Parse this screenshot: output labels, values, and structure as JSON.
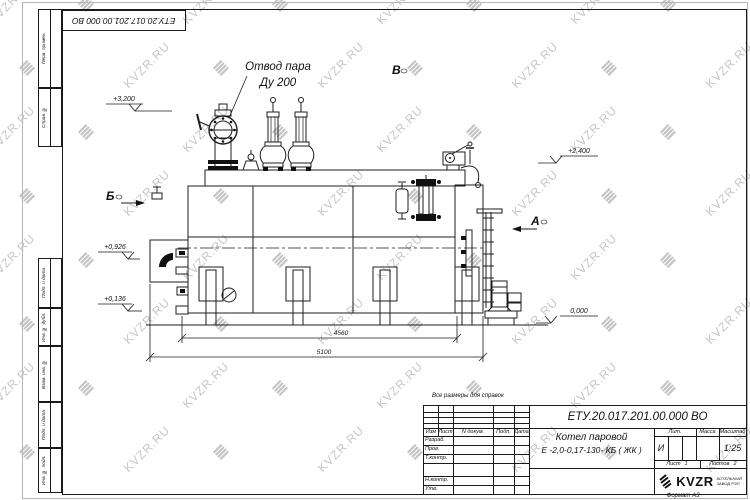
{
  "watermark": {
    "text": "KVZR.RU",
    "icon_glyph": "≣"
  },
  "stamp_top": {
    "doc_number": "ЕТУ.20.017.201.00.000  ВО"
  },
  "margin": {
    "labels": [
      "Перв. примен.",
      "Справ. №",
      "Подп. и дата",
      "Инв. № дубл.",
      "Взам. инв. №",
      "Подп. и дата",
      "Инв. № подл."
    ]
  },
  "drawing": {
    "callout": {
      "line1": "Отвод пара",
      "line2": "Ду 200"
    },
    "note": "Все размеры для справок",
    "elevations": {
      "e3200": "+3,200",
      "e2400": "+2,400",
      "e0926": "+0,926",
      "e0136": "+0,136",
      "e0000": "0,000"
    },
    "sections": {
      "b": "Б",
      "v": "В",
      "a": "А"
    },
    "dimensions": {
      "d4560": "4560",
      "d5100": "5100"
    }
  },
  "title_block": {
    "doc_number": "ЕТУ.20.017.201.00.000  ВО",
    "name_line1": "Котел паровой",
    "name_line2": "Е -2,0-0,17-130- КБ ( ЖК )",
    "cols": {
      "izm": "Изм",
      "list": "Лист",
      "doc": "N докум.",
      "podp": "Подп.",
      "data": "Дата"
    },
    "rows": {
      "r1": "Разраб.",
      "r2": "Пров.",
      "r3": "Т.контр.",
      "r4": "Н.контр.",
      "r5": "Утв."
    },
    "lit": {
      "label": "Лит.",
      "value": "И"
    },
    "mass": {
      "label": "Масса",
      "value": ""
    },
    "scale": {
      "label": "Масштаб",
      "value": "1:25"
    },
    "sheet": {
      "label": "Лист",
      "value": "1"
    },
    "sheets": {
      "label": "Листов",
      "value": "2"
    },
    "company": {
      "logo_text": "KVZR",
      "line1": "КОТЕЛЬНЫЙ",
      "line2": "ЗАВОД РЭП"
    },
    "format": "Формат А3"
  }
}
